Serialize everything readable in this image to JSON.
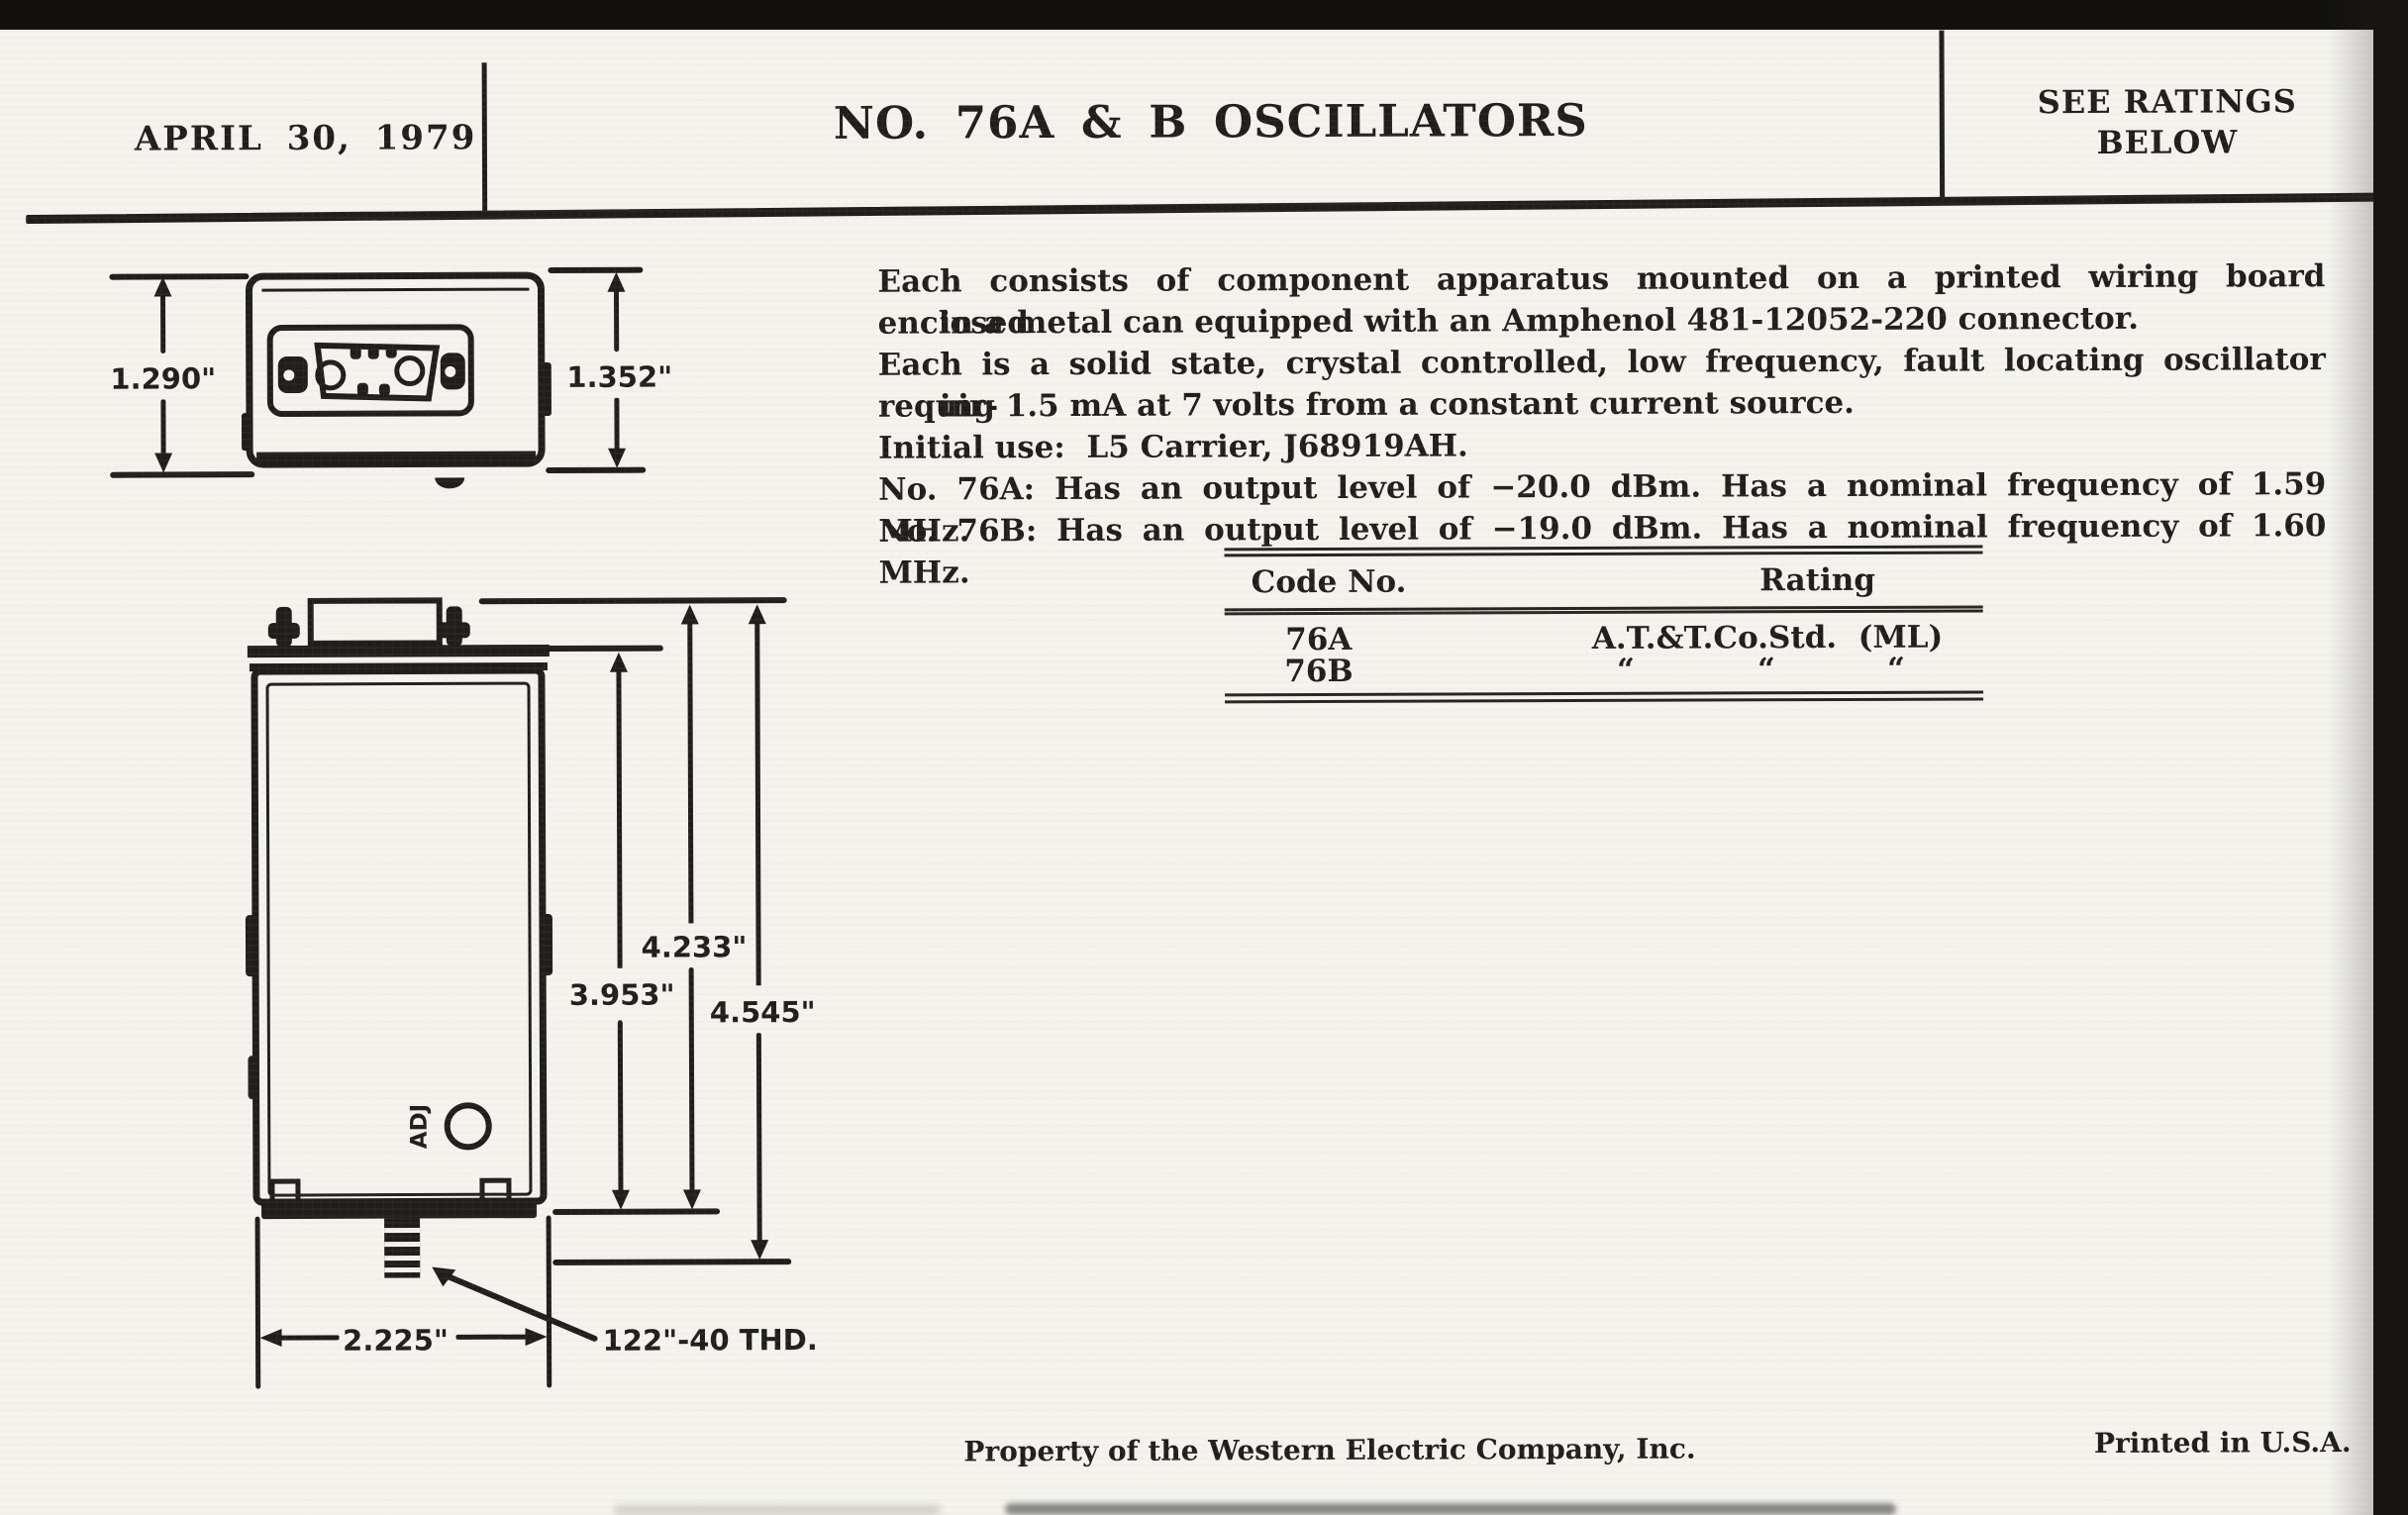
{
  "header": {
    "date": "APRIL 30, 1979",
    "title": "NO. 76A & B OSCILLATORS",
    "ratings_note_line1": "SEE RATINGS",
    "ratings_note_line2": "BELOW"
  },
  "description": {
    "lines": [
      {
        "text": "Each consists of component apparatus mounted on a printed wiring board enclosed"
      },
      {
        "text": "in a metal can equipped with an Amphenol 481-12052-220 connector."
      },
      {
        "text": "Each is a solid state, crystal controlled, low frequency, fault locating oscillator requir-"
      },
      {
        "text": "ing 1.5 mA at 7 volts from a constant current source."
      },
      {
        "text": "Initial use:  L5 Carrier, J68919AH."
      },
      {
        "text": "No. 76A:  Has an output level of −20.0 dBm.  Has a nominal frequency of 1.59 MHz."
      },
      {
        "text": "No. 76B:  Has an output level of −19.0 dBm.  Has a nominal frequency of 1.60 MHz."
      }
    ]
  },
  "table": {
    "header": {
      "code": "Code No.",
      "rating": "Rating"
    },
    "rows": [
      {
        "code": "76A",
        "rating": "A.T.&T.Co.Std.  (ML)"
      },
      {
        "code": "76B",
        "ditto": [
          "“",
          "“",
          "“"
        ]
      }
    ]
  },
  "top_view": {
    "dim_left": "1.290\"",
    "dim_right": "1.352\""
  },
  "front_view": {
    "dim_inner": "3.953\"",
    "dim_mid": "4.233\"",
    "dim_outer": "4.545\"",
    "dim_width": "2.225\"",
    "thread_label": "122\"-40 THD.",
    "adj_label": "ADJ"
  },
  "footer": {
    "property_note": "Property of the Western Electric Company, Inc.",
    "printed_note": "Printed in U.S.A."
  },
  "colors": {
    "ink": "#201e1b",
    "paper": "#f4f3ee"
  }
}
